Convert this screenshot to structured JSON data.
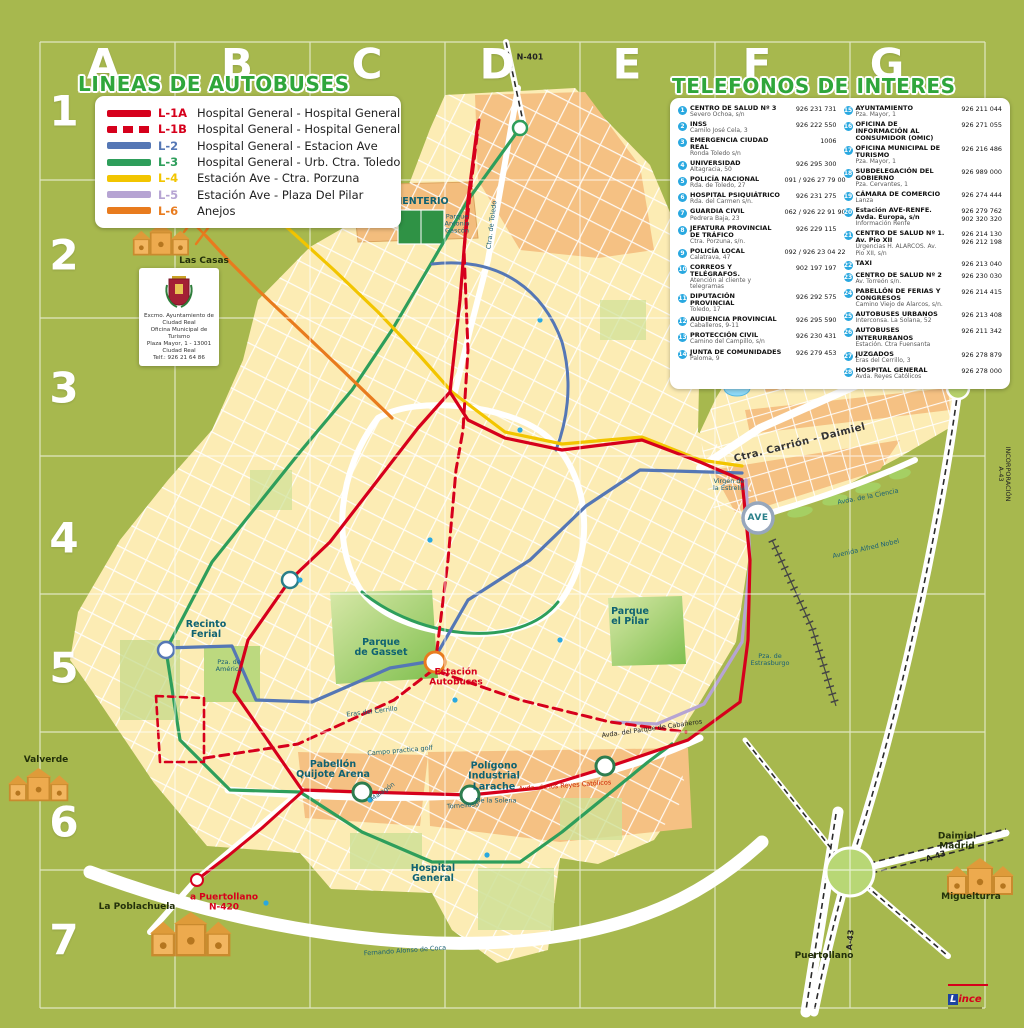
{
  "grid": {
    "columns": [
      "A",
      "B",
      "C",
      "D",
      "E",
      "F",
      "G"
    ],
    "rows": [
      "1",
      "2",
      "3",
      "4",
      "5",
      "6",
      "7"
    ]
  },
  "legend": {
    "title": "LINEAS DE AUTOBUSES",
    "lines": [
      {
        "id": "L-1A",
        "label": "Hospital General - Hospital General",
        "color": "#d6001c",
        "style": "solid"
      },
      {
        "id": "L-1B",
        "label": "Hospital General - Hospital General",
        "color": "#d6001c",
        "style": "dashed"
      },
      {
        "id": "L-2",
        "label": "Hospital General - Estacion Ave",
        "color": "#5577b5",
        "style": "solid"
      },
      {
        "id": "L-3",
        "label": "Hospital General - Urb. Ctra. Toledo",
        "color": "#2e9e5b",
        "style": "solid"
      },
      {
        "id": "L-4",
        "label": "Estación Ave - Ctra. Porzuna",
        "color": "#f2c500",
        "style": "solid"
      },
      {
        "id": "L-5",
        "label": "Estación Ave - Plaza Del Pilar",
        "color": "#b6a4d3",
        "style": "solid"
      },
      {
        "id": "L-6",
        "label": "Anejos",
        "color": "#e87b1e",
        "style": "solid"
      }
    ]
  },
  "directory": {
    "title": "TELEFONOS DE INTERES",
    "left": [
      {
        "n": "1",
        "name": "CENTRO DE SALUD Nº 3",
        "sub": "Severo Ochoa, s/n",
        "tel": "926 231 731"
      },
      {
        "n": "2",
        "name": "INSS",
        "sub": "Camilo José Cela, 3",
        "tel": "926 222 550"
      },
      {
        "n": "3",
        "name": "EMERGENCIA CIUDAD REAL",
        "sub": "Ronda Toledo s/n",
        "tel": "1006"
      },
      {
        "n": "4",
        "name": "UNIVERSIDAD",
        "sub": "Altagracia, 50",
        "tel": "926 295 300"
      },
      {
        "n": "5",
        "name": "POLICÍA NACIONAL",
        "sub": "Rda. de Toledo, 27",
        "tel": "091 / 926 27 79 00"
      },
      {
        "n": "6",
        "name": "HOSPITAL PSIQUIÁTRICO",
        "sub": "Rda. del Carmen s/n.",
        "tel": "926 231 275"
      },
      {
        "n": "7",
        "name": "GUARDIA CIVIL",
        "sub": "Pedrera Baja, 23",
        "tel": "062 / 926 22 91 90"
      },
      {
        "n": "8",
        "name": "JEFATURA PROVINCIAL DE TRÁFICO",
        "sub": "Ctra. Porzuna, s/n.",
        "tel": "926 229 115"
      },
      {
        "n": "9",
        "name": "POLICÍA LOCAL",
        "sub": "Calatrava, 47",
        "tel": "092 / 926 23 04 22"
      },
      {
        "n": "10",
        "name": "CORREOS Y TELÉGRAFOS.",
        "sub": "Atención al cliente y telegramas",
        "tel": "902 197 197"
      },
      {
        "n": "11",
        "name": "DIPUTACIÓN PROVINCIAL",
        "sub": "Toledo, 17",
        "tel": "926 292 575"
      },
      {
        "n": "12",
        "name": "AUDIENCIA PROVINCIAL",
        "sub": "Caballeros, 9-11",
        "tel": "926 295 590"
      },
      {
        "n": "13",
        "name": "PROTECCIÓN CIVIL",
        "sub": "Camino del Campillo, s/n",
        "tel": "926 230 431"
      },
      {
        "n": "14",
        "name": "JUNTA DE COMUNIDADES",
        "sub": "Paloma, 9",
        "tel": "926 279 453"
      }
    ],
    "right": [
      {
        "n": "15",
        "name": "AYUNTAMIENTO",
        "sub": "Pza. Mayor, 1",
        "tel": "926 211 044"
      },
      {
        "n": "16",
        "name": "OFICINA DE INFORMACIÓN AL CONSUMIDOR (OMIC)",
        "sub": "",
        "tel": "926 271 055"
      },
      {
        "n": "17",
        "name": "OFICINA MUNICIPAL DE TURISMO",
        "sub": "Pza. Mayor, 1",
        "tel": "926 216 486"
      },
      {
        "n": "18",
        "name": "SUBDELEGACIÓN DEL GOBIERNO",
        "sub": "Pza. Cervantes, 1",
        "tel": "926 989 000"
      },
      {
        "n": "19",
        "name": "CÁMARA DE COMERCIO",
        "sub": "Lanza",
        "tel": "926 274 444"
      },
      {
        "n": "20",
        "name": "Estación AVE-RENFE. Avda. Europa, s/n",
        "sub": "Información Renfe",
        "tel": "926 279 762",
        "tel2": "902 320 320"
      },
      {
        "n": "21",
        "name": "CENTRO DE SALUD Nº 1. Av. Pio XII",
        "sub": "Urgencias H. ALARCOS. Av. Pio XII, s/n",
        "tel": "926 214 130",
        "tel2": "926 212 198"
      },
      {
        "n": "22",
        "name": "TAXI",
        "sub": "",
        "tel": "926 213 040"
      },
      {
        "n": "23",
        "name": "CENTRO DE SALUD Nº 2",
        "sub": "Av. Torreón s/n.",
        "tel": "926 230 030"
      },
      {
        "n": "24",
        "name": "PABELLÓN DE FERIAS Y CONGRESOS",
        "sub": "Camino Viejo de Alarcos, s/n.",
        "tel": "926 214 415"
      },
      {
        "n": "25",
        "name": "AUTOBUSES URBANOS",
        "sub": "Interconsa. La Solana, 52",
        "tel": "926 213 408"
      },
      {
        "n": "26",
        "name": "AUTOBUSES INTERURBANOS",
        "sub": "Estación. Ctra Fuensanta",
        "tel": "926 211 342"
      },
      {
        "n": "27",
        "name": "JUZGADOS",
        "sub": "Eras del Cerrillo, 3",
        "tel": "926 278 879"
      },
      {
        "n": "28",
        "name": "HOSPITAL GENERAL",
        "sub": "Avda. Reyes Católicos",
        "tel": "926 278 000"
      }
    ]
  },
  "infobox": {
    "lines": [
      "Excmo. Ayuntamiento de Ciudad Real",
      "Oficina Municipal de Turismo",
      "Plaza Mayor, 1 - 13001 Ciudad Real",
      "Telf.: 926 21 64 86"
    ]
  },
  "logo": {
    "l": "L",
    "rest": "ince"
  },
  "colors": {
    "background": "#a7b84e",
    "city": "#fcecb4",
    "industrial": "#f5c183",
    "park_dark": "#7fbf4e",
    "park_light": "#d8e8a8",
    "water": "#8ed8f5",
    "poi": "#29a8e0",
    "title_green": "#2fa63b",
    "label_teal": "#0f6272"
  },
  "map_labels": [
    {
      "t": "N-401",
      "x": 530,
      "y": 58,
      "c": "dark-xs2"
    },
    {
      "t": "CEMENTERIO",
      "x": 414,
      "y": 202,
      "c": "area-xs"
    },
    {
      "t": "Parque\nAntonio\nGascón",
      "x": 457,
      "y": 224,
      "c": "street"
    },
    {
      "t": "Ctra. de Toledo",
      "x": 492,
      "y": 225,
      "c": "street",
      "r": -83
    },
    {
      "t": "Las Casas",
      "x": 204,
      "y": 262,
      "c": "town"
    },
    {
      "t": "Valverde",
      "x": 46,
      "y": 761,
      "c": "town"
    },
    {
      "t": "La Poblachuela",
      "x": 137,
      "y": 908,
      "c": "town"
    },
    {
      "t": "a Puertollano\nN-420",
      "x": 224,
      "y": 903,
      "c": "red-sm"
    },
    {
      "t": "Puertollano",
      "x": 824,
      "y": 957,
      "c": "town"
    },
    {
      "t": "Daimiel\nMadrid",
      "x": 957,
      "y": 842,
      "c": "town"
    },
    {
      "t": "Miguelturra",
      "x": 971,
      "y": 898,
      "c": "town"
    },
    {
      "t": "A-43",
      "x": 936,
      "y": 857,
      "c": "dark-xs2",
      "r": -18
    },
    {
      "t": "A-43",
      "x": 851,
      "y": 940,
      "c": "dark-xs2",
      "r": -85
    },
    {
      "t": "Dirección A-43",
      "x": 960,
      "y": 357,
      "c": "dark-xs2"
    },
    {
      "t": "N-430",
      "x": 983,
      "y": 383,
      "c": "dark-xs2"
    },
    {
      "t": "INCORPORACIÓN A-43",
      "x": 1004,
      "y": 474,
      "c": "dark-3",
      "r": 90
    },
    {
      "t": "Ctra. Carrión - Daimiel",
      "x": 800,
      "y": 444,
      "c": "dark-sm2",
      "r": -14
    },
    {
      "t": "Avda. de la Ciencia",
      "x": 868,
      "y": 497,
      "c": "street",
      "r": -11
    },
    {
      "t": "Avenida Alfred Nobel",
      "x": 866,
      "y": 549,
      "c": "street",
      "r": -13
    },
    {
      "t": "Recinto\nFerial",
      "x": 206,
      "y": 630,
      "c": "area-xs"
    },
    {
      "t": "Pza. de\nAmérica",
      "x": 229,
      "y": 666,
      "c": "street"
    },
    {
      "t": "Parque\nde Gasset",
      "x": 381,
      "y": 648,
      "c": "area-xs"
    },
    {
      "t": "Estación\nAutobuses",
      "x": 456,
      "y": 678,
      "c": "red-sm"
    },
    {
      "t": "Parque\nel Pilar",
      "x": 630,
      "y": 617,
      "c": "area-xs"
    },
    {
      "t": "Pza. de\nEstrasburgo",
      "x": 770,
      "y": 660,
      "c": "street"
    },
    {
      "t": "Polígono\nIndustrial\nLarache",
      "x": 494,
      "y": 777,
      "c": "area-xs"
    },
    {
      "t": "De la Solena",
      "x": 496,
      "y": 801,
      "c": "street"
    },
    {
      "t": "Pabellón\nQuijote Arena",
      "x": 333,
      "y": 770,
      "c": "area-xs"
    },
    {
      "t": "Campo practica golf",
      "x": 400,
      "y": 751,
      "c": "street",
      "r": -5
    },
    {
      "t": "Hospital\nGeneral",
      "x": 433,
      "y": 874,
      "c": "area-xs"
    },
    {
      "t": "Tomelloso",
      "x": 463,
      "y": 806,
      "c": "street",
      "r": -4
    },
    {
      "t": "Malagón",
      "x": 383,
      "y": 792,
      "c": "street",
      "r": -35
    },
    {
      "t": "Fernando Alonso de Coca",
      "x": 405,
      "y": 951,
      "c": "street",
      "r": -4
    },
    {
      "t": "Avda. de los Reyes Católicos",
      "x": 565,
      "y": 786,
      "c": "red-xs",
      "r": -4
    },
    {
      "t": "Virgen de\nla Estrella",
      "x": 729,
      "y": 485,
      "c": "street"
    },
    {
      "t": "Avda. del Parque de Cabañeros",
      "x": 652,
      "y": 729,
      "c": "dark-3",
      "r": -8
    },
    {
      "t": "Eras del Cerrillo",
      "x": 372,
      "y": 712,
      "c": "street",
      "r": -7
    },
    {
      "t": "AVE",
      "x": 758,
      "y": 519,
      "c": "ave"
    }
  ]
}
